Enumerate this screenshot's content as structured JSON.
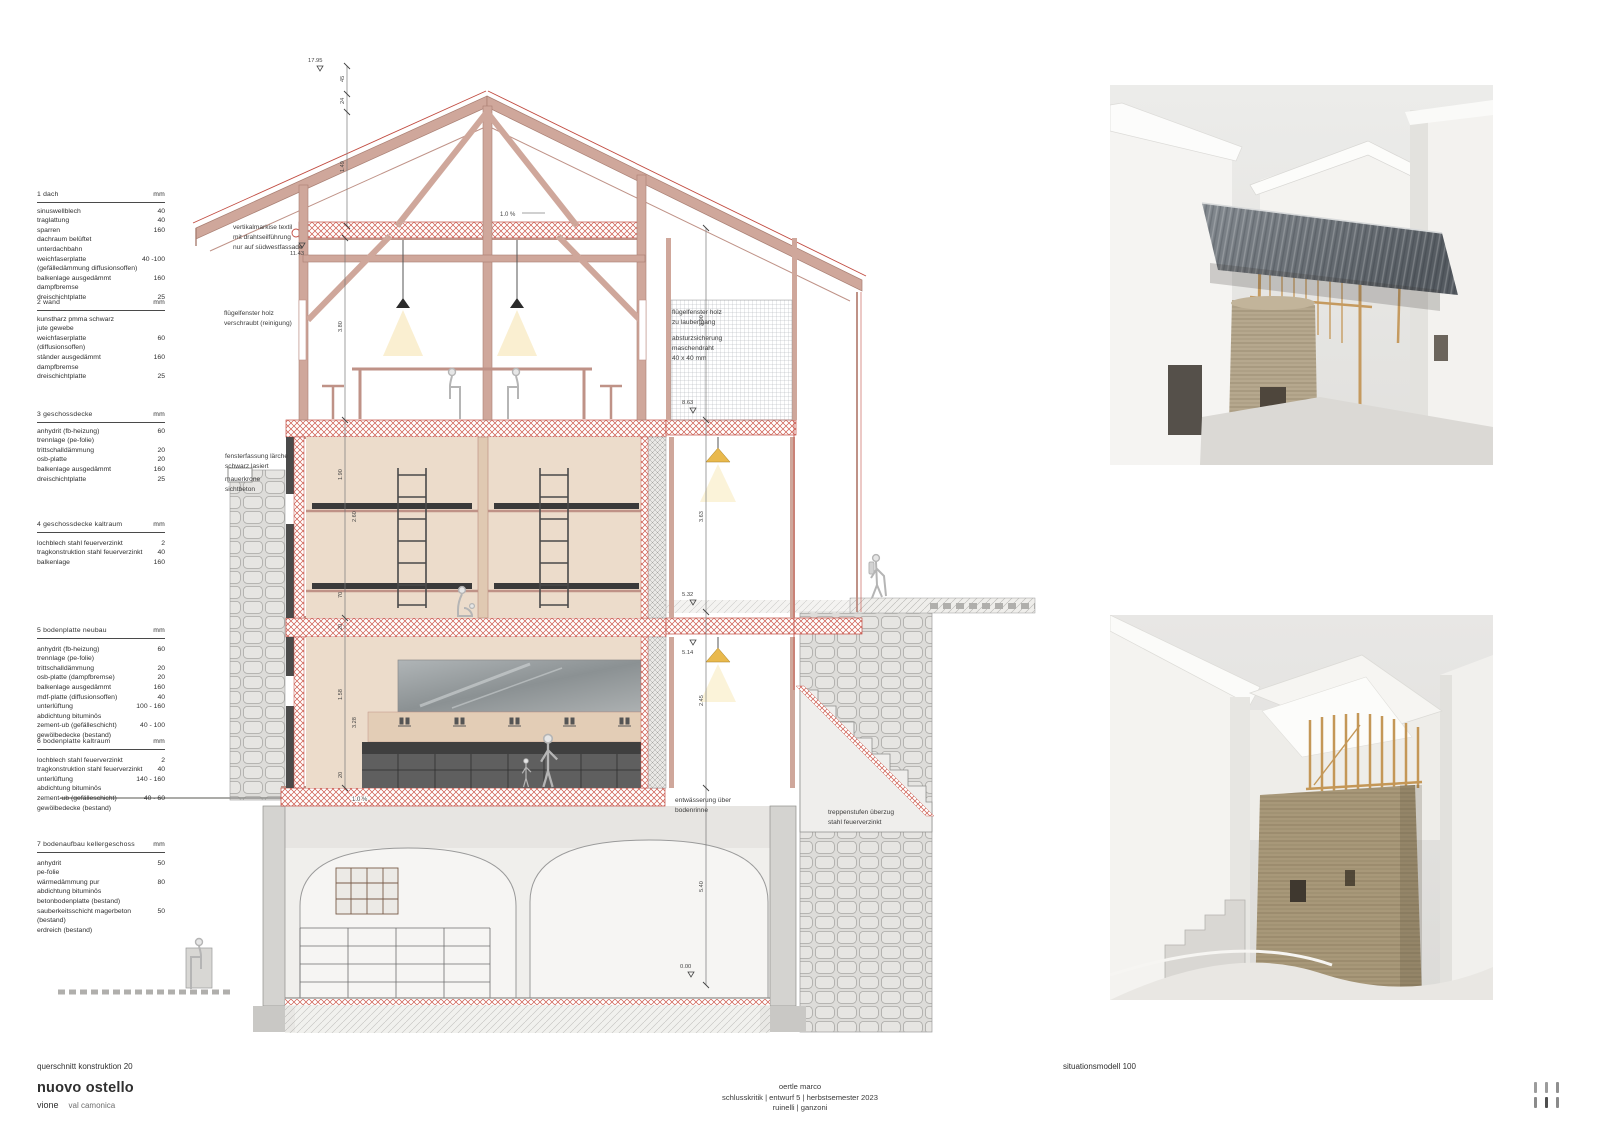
{
  "titles": {
    "drawing_caption": "querschnitt konstruktion 20",
    "project_title": "nuovo ostello",
    "project_place": "vione",
    "project_region": "val camonica",
    "credit_name": "oertle marco",
    "credit_line": "schlusskritik | entwurf 5 | herbstsemester 2023",
    "credit_profs": "ruinelli | ganzoni",
    "model_caption": "situationsmodell 100"
  },
  "spec_tables": [
    {
      "title": "1 dach",
      "unit": "mm",
      "rows": [
        {
          "label": "sinuswellblech",
          "value": "40"
        },
        {
          "label": "traglattung",
          "value": "40"
        },
        {
          "label": "sparren",
          "value": "160"
        },
        {
          "label": "dachraum belüftet",
          "value": ""
        },
        {
          "label": "unterdachbahn",
          "value": ""
        },
        {
          "label": "weichfaserplatte",
          "value": "40 -100"
        },
        {
          "label": "(gefälledämmung diffusionsoffen)",
          "value": ""
        },
        {
          "label": "balkenlage ausgedämmt",
          "value": "160"
        },
        {
          "label": "dampfbremse",
          "value": ""
        },
        {
          "label": "dreischichtplatte",
          "value": "25"
        }
      ]
    },
    {
      "title": "2 wand",
      "unit": "mm",
      "rows": [
        {
          "label": "kunstharz pmma schwarz",
          "value": ""
        },
        {
          "label": "jute gewebe",
          "value": ""
        },
        {
          "label": "weichfaserplatte",
          "value": "60"
        },
        {
          "label": "(diffusionsoffen)",
          "value": ""
        },
        {
          "label": "ständer ausgedämmt",
          "value": "160"
        },
        {
          "label": "dampfbremse",
          "value": ""
        },
        {
          "label": "dreischichtplatte",
          "value": "25"
        }
      ]
    },
    {
      "title": "3 geschossdecke",
      "unit": "mm",
      "rows": [
        {
          "label": "anhydrit (fb-heizung)",
          "value": "60"
        },
        {
          "label": "trennlage (pe-folie)",
          "value": ""
        },
        {
          "label": "trittschalldämmung",
          "value": "20"
        },
        {
          "label": "osb-platte",
          "value": "20"
        },
        {
          "label": "balkenlage ausgedämmt",
          "value": "160"
        },
        {
          "label": "dreischichtplatte",
          "value": "25"
        }
      ]
    },
    {
      "title": "4 geschossdecke kaltraum",
      "unit": "mm",
      "rows": [
        {
          "label": "lochblech stahl feuerverzinkt",
          "value": "2"
        },
        {
          "label": "tragkonstruktion stahl feuerverzinkt",
          "value": "40"
        },
        {
          "label": "balkenlage",
          "value": "160"
        }
      ]
    },
    {
      "title": "5 bodenplatte neubau",
      "unit": "mm",
      "rows": [
        {
          "label": "anhydrit (fb-heizung)",
          "value": "60"
        },
        {
          "label": "trennlage (pe-folie)",
          "value": ""
        },
        {
          "label": "trittschalldämmung",
          "value": "20"
        },
        {
          "label": "osb-platte (dampfbremse)",
          "value": "20"
        },
        {
          "label": "balkenlage ausgedämmt",
          "value": "160"
        },
        {
          "label": "mdf-platte (diffusionsoffen)",
          "value": "40"
        },
        {
          "label": "unterlüftung",
          "value": "100 - 160"
        },
        {
          "label": "abdichtung bituminös",
          "value": ""
        },
        {
          "label": "zement-ub (gefälleschicht)",
          "value": "40 - 100"
        },
        {
          "label": "gewölbedecke (bestand)",
          "value": ""
        }
      ]
    },
    {
      "title": "6 bodenplatte kaltraum",
      "unit": "mm",
      "rows": [
        {
          "label": "lochblech stahl feuerverzinkt",
          "value": "2"
        },
        {
          "label": "tragkonstruktion stahl feuerverzinkt",
          "value": "40"
        },
        {
          "label": "unterlüftung",
          "value": "140 - 160"
        },
        {
          "label": "abdichtung bituminös",
          "value": ""
        },
        {
          "label": "zement-ub (gefälleschicht)",
          "value": "40 - 60"
        },
        {
          "label": "gewölbedecke (bestand)",
          "value": ""
        }
      ]
    },
    {
      "title": "7 bodenaufbau kellergeschoss",
      "unit": "mm",
      "rows": [
        {
          "label": "anhydrit",
          "value": "50"
        },
        {
          "label": "pe-folie",
          "value": ""
        },
        {
          "label": "wärmedämmung pur",
          "value": "80"
        },
        {
          "label": "abdichtung bituminös",
          "value": ""
        },
        {
          "label": "betonbodenplatte (bestand)",
          "value": ""
        },
        {
          "label": "sauberkeitsschicht magerbeton (bestand)",
          "value": "50"
        },
        {
          "label": "erdreich (bestand)",
          "value": ""
        }
      ]
    }
  ],
  "annotations": {
    "markise": "vertikalmarkise textil\nmit drahtseilführung\nnur auf südwestfassade",
    "fenster_left": "flügelfenster holz\nverschraubt (reinigung)",
    "fenster_right": "flügelfenster holz\nzu laubengang",
    "absturz": "absturzsicherung\nmaschendraht\n40 x 40 mm",
    "fassung": "fensterfassung lärche\nschwarz lasiert",
    "mauerkrone": "mauerkrone\nsichtbeton",
    "entwaesserung": "entwässerung über\nbodenrinne",
    "treppe": "treppenstufen überzug\nstahl feuerverzinkt"
  },
  "dims": {
    "elev_top": "17.95",
    "elev_attic": "11.43",
    "e863": "8.63",
    "e532": "5.32",
    "e514": "5.14",
    "e000": "0.00",
    "s45": "45",
    "s24": "24",
    "s149": "1.49",
    "s380": "3.80",
    "s190": "1.90",
    "s260": "2.60",
    "s70": "70",
    "s20a": "20",
    "s158": "1.58",
    "s328": "3.28",
    "s20b": "20",
    "s390": "3.90",
    "s363": "3.63",
    "s245": "2.45",
    "s540": "5.40",
    "slope_top": "1.0 %",
    "slope_floor": "1.0 %"
  },
  "colors": {
    "accent_red": "#c14b40",
    "timber": "#cfa79b",
    "wood": "#ecdccb",
    "dark": "#3e3e3e"
  }
}
